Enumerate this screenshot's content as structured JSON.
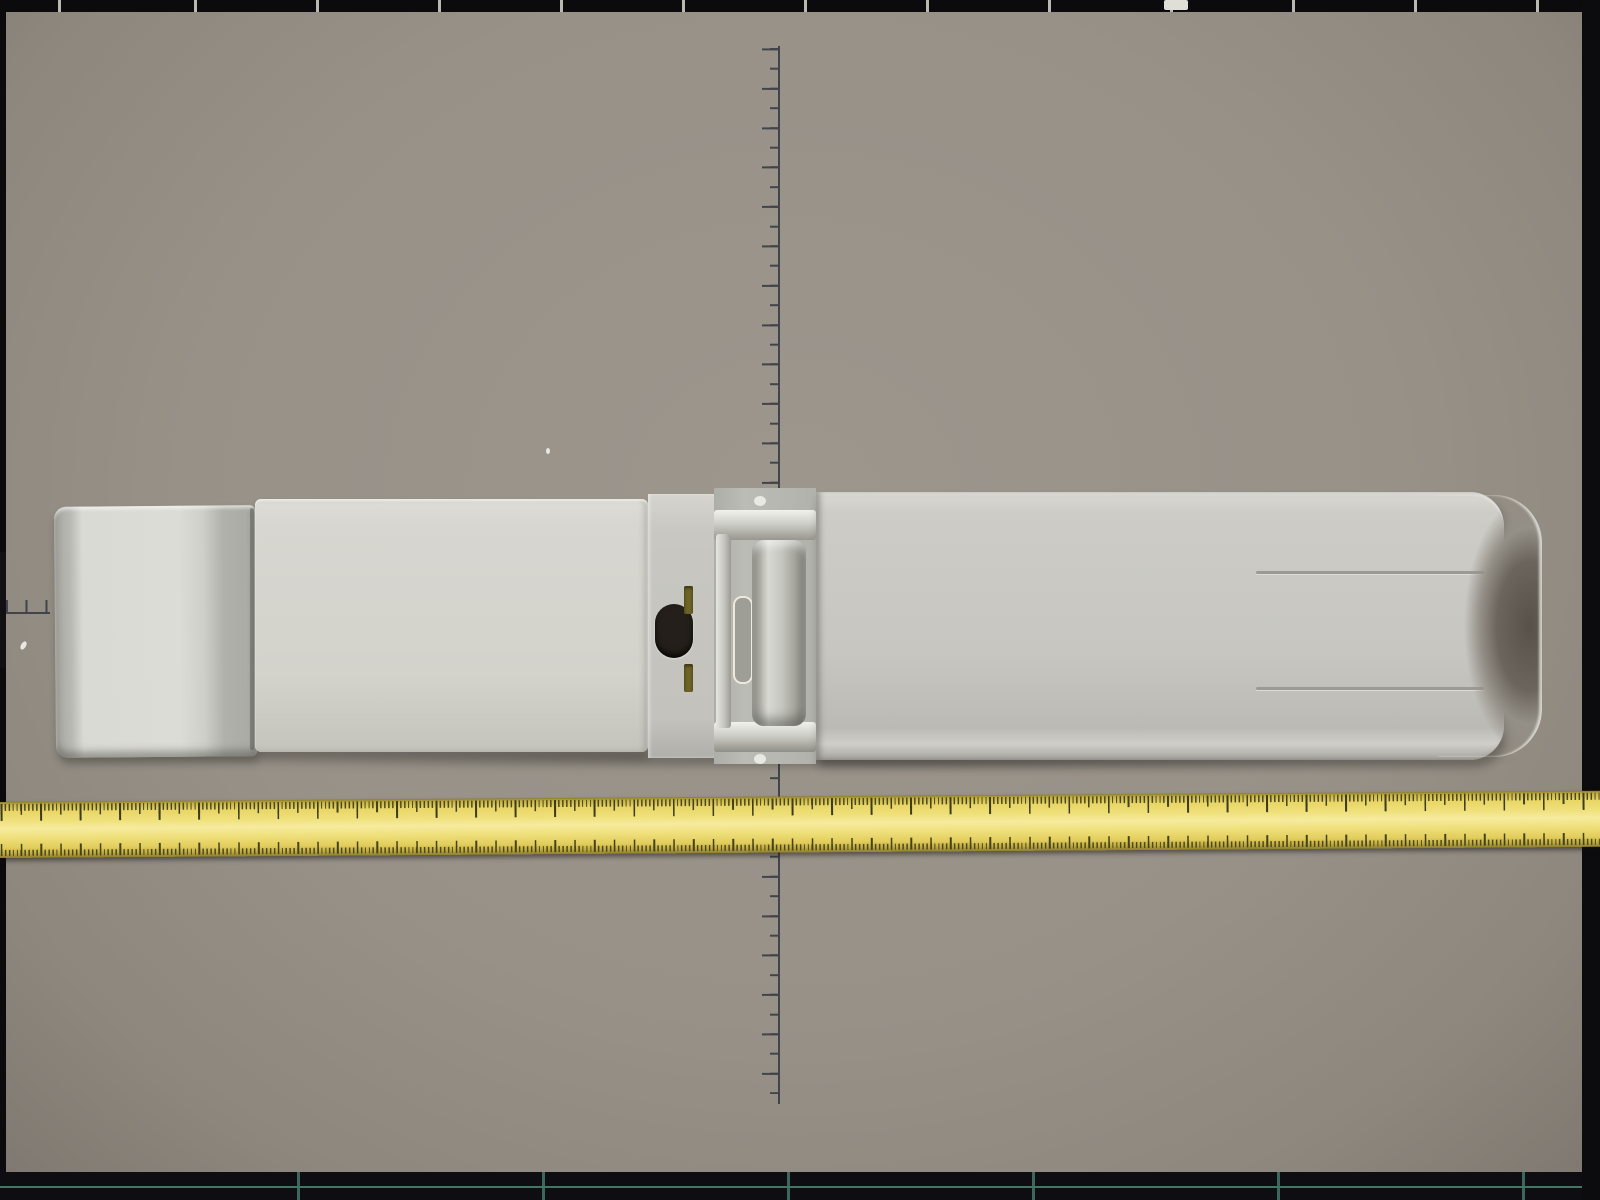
{
  "colors": {
    "board_gray": "#979188",
    "line_dark": "#43434b",
    "device_gray": "#d3d2cb",
    "tape_yellow": "#efe07b",
    "tape_highlight_box": "#e8600f"
  },
  "board": {
    "rectangles": [
      {
        "id": "B4",
        "label": "B4  (257×364)"
      },
      {
        "id": "B5",
        "label": "B5  (182×257)"
      },
      {
        "id": "B6",
        "label": "B6  (128×182)"
      },
      {
        "id": "B7",
        "label": "B7  (91×128)"
      },
      {
        "id": "B8",
        "label": "B8(64×91)"
      }
    ],
    "vertical_ruler_labels": [
      {
        "text": "10"
      },
      {
        "text": "5"
      },
      {
        "text": "10"
      }
    ],
    "horizontal_ruler_label": "20"
  },
  "device": {
    "keypad": {
      "keys": [
        {
          "letters": "",
          "digit": "☼",
          "type": "light",
          "name": "light-key"
        },
        {
          "letters": "QZ",
          "digit": "0",
          "type": "num",
          "name": "key-0"
        },
        {
          "letters": "",
          "digit": "ENTER",
          "type": "enter",
          "name": "enter-key"
        },
        {
          "letters": "PRS",
          "digit": "7",
          "type": "num",
          "name": "key-7"
        },
        {
          "letters": "TUV",
          "digit": "8",
          "type": "num",
          "name": "key-8"
        },
        {
          "letters": "WXY",
          "digit": "9",
          "type": "num",
          "name": "key-9"
        },
        {
          "letters": "GHI",
          "digit": "4",
          "type": "num",
          "name": "key-4"
        },
        {
          "letters": "JKL",
          "digit": "5",
          "type": "num",
          "name": "key-5"
        },
        {
          "letters": "MNO",
          "digit": "6",
          "type": "num",
          "name": "key-6"
        },
        {
          "letters": "",
          "digit": "1",
          "type": "num",
          "name": "key-1"
        },
        {
          "letters": "ABC",
          "digit": "2",
          "type": "num",
          "name": "key-2"
        },
        {
          "letters": "DEF",
          "digit": "3",
          "type": "num",
          "name": "key-3"
        }
      ]
    }
  },
  "tape": {
    "marks": [
      {
        "cm": 174,
        "label": "4"
      },
      {
        "cm": 175,
        "label": "5"
      },
      {
        "cm": 176,
        "label": "6"
      },
      {
        "cm": 177,
        "label": "7"
      },
      {
        "cm": 178,
        "label": "8"
      },
      {
        "cm": 179,
        "label": "9"
      },
      {
        "cm": 180,
        "label": "180"
      },
      {
        "cm": 181,
        "label": "1"
      },
      {
        "cm": 182,
        "label": "2"
      },
      {
        "cm": 183,
        "label": "3"
      },
      {
        "cm": 184,
        "label": "4"
      },
      {
        "cm": 185,
        "label": "5"
      },
      {
        "cm": 186,
        "label": "6"
      },
      {
        "cm": 187,
        "label": "7"
      },
      {
        "cm": 188,
        "label": "8"
      },
      {
        "cm": 189,
        "label": "9"
      },
      {
        "cm": 190,
        "label": "190"
      },
      {
        "cm": 191,
        "label": "1"
      },
      {
        "cm": 192,
        "label": "2"
      },
      {
        "cm": 193,
        "label": "3"
      },
      {
        "cm": 194,
        "label": "4"
      },
      {
        "cm": 195,
        "label": "5"
      },
      {
        "cm": 196,
        "label": "6"
      },
      {
        "cm": 197,
        "label": "7"
      },
      {
        "cm": 198,
        "label": "8"
      },
      {
        "cm": 199,
        "label": "9"
      },
      {
        "cm": 200,
        "label": "200"
      },
      {
        "cm": 201,
        "label": "1"
      },
      {
        "cm": 202,
        "label": "2"
      },
      {
        "cm": 203,
        "label": "3"
      },
      {
        "cm": 204,
        "label": "4"
      },
      {
        "cm": 205,
        "label": "5"
      },
      {
        "cm": 206,
        "label": "6"
      },
      {
        "cm": 207,
        "label": "7"
      },
      {
        "cm": 208,
        "label": "8"
      },
      {
        "cm": 209,
        "label": "9"
      },
      {
        "cm": 210,
        "label": "210"
      },
      {
        "cm": 211,
        "label": "1"
      },
      {
        "cm": 212,
        "label": "2"
      },
      {
        "cm": 213,
        "label": "3"
      },
      {
        "cm": 214,
        "label": "4"
      }
    ]
  }
}
